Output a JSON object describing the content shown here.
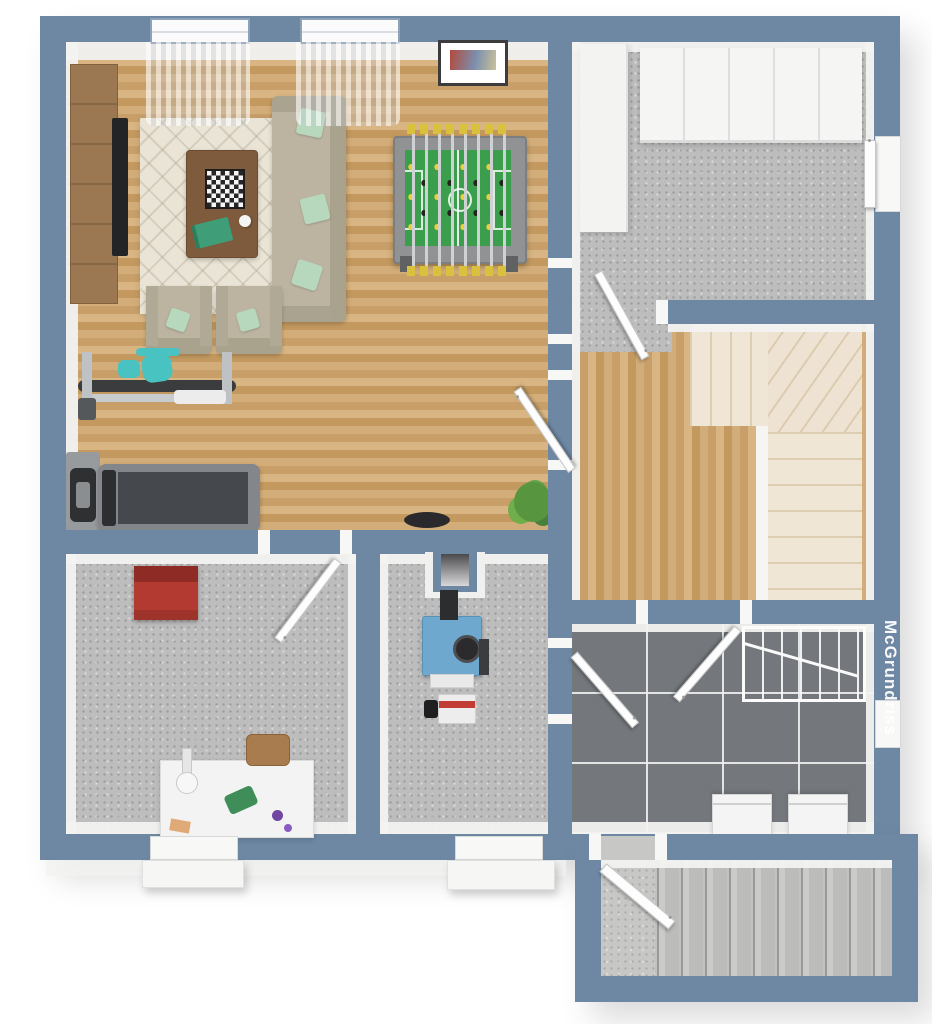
{
  "watermark": {
    "text": "McGrundriss"
  },
  "palette": {
    "wall": "#6e88a3",
    "wall_face": "#f2f2f1",
    "wood_floor": "#cda771",
    "concrete_floor": "#bdbdbd",
    "tile_floor": "#74787c",
    "tile_grout": "#eeeeee",
    "stair_cream": "#f0e6d6",
    "stair_concrete": "#c2c2c0",
    "rug": "#eae4d6",
    "sofa": "#bcb4a1",
    "pillow_mint": "#b7d8bd",
    "wood_furniture": "#9b7851",
    "foosball_green": "#3a9e4d",
    "foosball_yellow": "#e0c53a",
    "machine_teal": "#49c2c2",
    "treadmill_gray": "#45484c",
    "tool_chest_red": "#b23a31",
    "boiler_blue": "#6ea8cf",
    "background": "#ffffff"
  },
  "rooms": [
    {
      "name": "living-games-room",
      "floor": "wood",
      "furniture": [
        "sideboard",
        "tv",
        "rug",
        "coffee-table",
        "chessboard",
        "book",
        "sofa",
        "armchair-left",
        "armchair-right",
        "foosball-table",
        "exercise-machine",
        "treadmill",
        "wall-mat-device",
        "wall-picture",
        "potted-plant",
        "dark-bowl",
        "window",
        "window",
        "curtains"
      ]
    },
    {
      "name": "storage-room",
      "floor": "concrete",
      "furniture": [
        "wardrobe-cabinets",
        "tall-cabinet",
        "side-door"
      ]
    },
    {
      "name": "hallway",
      "floor": "wood",
      "furniture": [
        "winder-staircase",
        "concrete-landing"
      ]
    },
    {
      "name": "workshop",
      "floor": "concrete",
      "furniture": [
        "tool-chest",
        "workbench",
        "work-gloves",
        "gem-stones",
        "hand-tool",
        "stool",
        "exterior-door-step"
      ]
    },
    {
      "name": "boiler-room",
      "floor": "concrete",
      "furniture": [
        "boiler",
        "chimney",
        "flue-pipe",
        "burner-unit",
        "exterior-door-step"
      ]
    },
    {
      "name": "laundry-room",
      "floor": "tile",
      "furniture": [
        "drying-rack",
        "washing-machine",
        "dryer",
        "side-door"
      ]
    },
    {
      "name": "basement-entrance",
      "floor": "concrete",
      "furniture": [
        "exterior-staircase",
        "entry-door"
      ]
    }
  ]
}
